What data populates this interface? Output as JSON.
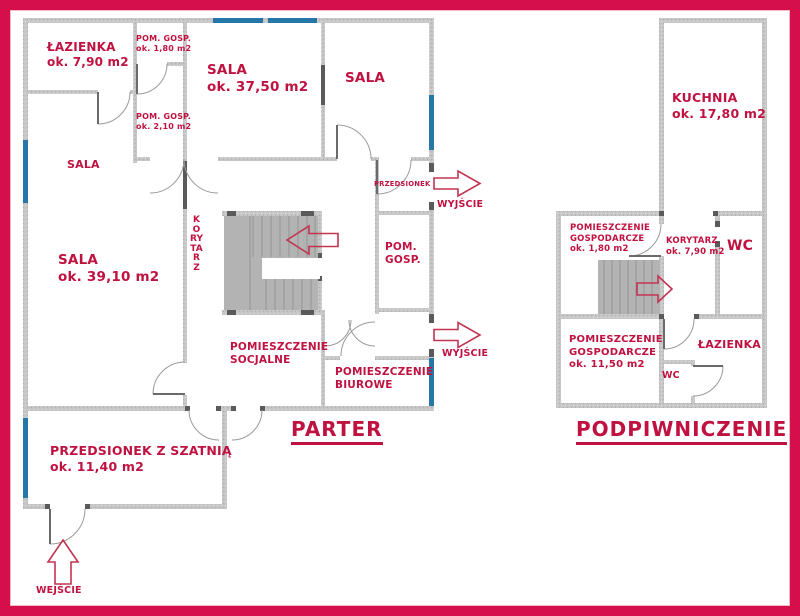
{
  "colors": {
    "frame": "#d50f4c",
    "wall": "#c6c6c6",
    "wall_dark": "#5a5a5a",
    "window": "#2676a8",
    "stairs": "#b3b3b3",
    "text": "#c01240",
    "arrow": "#c13552"
  },
  "parter": {
    "title": "PARTER",
    "rooms": {
      "lazienka": {
        "name": "ŁAZIENKA",
        "area": "ok. 7,90 m2"
      },
      "pom_gosp_1": {
        "name": "POM. GOSP.",
        "area": "ok. 1,80 m2"
      },
      "sala_duza": {
        "name": "SALA",
        "area": "ok. 37,50 m2"
      },
      "sala_prawa": {
        "name": "SALA"
      },
      "pom_gosp_2": {
        "name": "POM. GOSP.",
        "area": "ok. 2,10 m2"
      },
      "sala_lewa": {
        "name": "SALA"
      },
      "sala_3910": {
        "name": "SALA",
        "area": "ok. 39,10 m2"
      },
      "korytarz": {
        "name": "KORYTARZ"
      },
      "przedsionek": {
        "name": "PRZEDSIONEK"
      },
      "pom_gosp_3": {
        "name": "POM.",
        "name2": "GOSP."
      },
      "socjalne": {
        "name": "POMIESZCZENIE",
        "name2": "SOCJALNE"
      },
      "biurowe": {
        "name": "POMIESZCZENIE",
        "name2": "BIUROWE"
      },
      "szatnia": {
        "name": "PRZEDSIONEK Z SZATNIĄ",
        "area": "ok. 11,40 m2"
      }
    },
    "exits": {
      "wyjscie1": "WYJŚCIE",
      "wyjscie2": "WYJŚCIE",
      "wejscie": "WEJŚCIE"
    }
  },
  "podpiwniczenie": {
    "title": "PODPIWNICZENIE",
    "rooms": {
      "kuchnia": {
        "name": "KUCHNIA",
        "area": "ok. 17,80 m2"
      },
      "gospodarcze_male": {
        "name": "POMIESZCZENIE",
        "name2": "GOSPODARCZE",
        "area": "ok. 1,80 m2"
      },
      "korytarz": {
        "name": "KORYTARZ",
        "area": "ok. 7,90 m2"
      },
      "wc_gorne": {
        "name": "WC"
      },
      "gospodarcze_duze": {
        "name": "POMIESZCZENIE",
        "name2": "GOSPODARCZE",
        "area": "ok. 11,50 m2"
      },
      "lazienka": {
        "name": "ŁAZIENKA"
      },
      "wc_dolne": {
        "name": "WC"
      }
    }
  }
}
